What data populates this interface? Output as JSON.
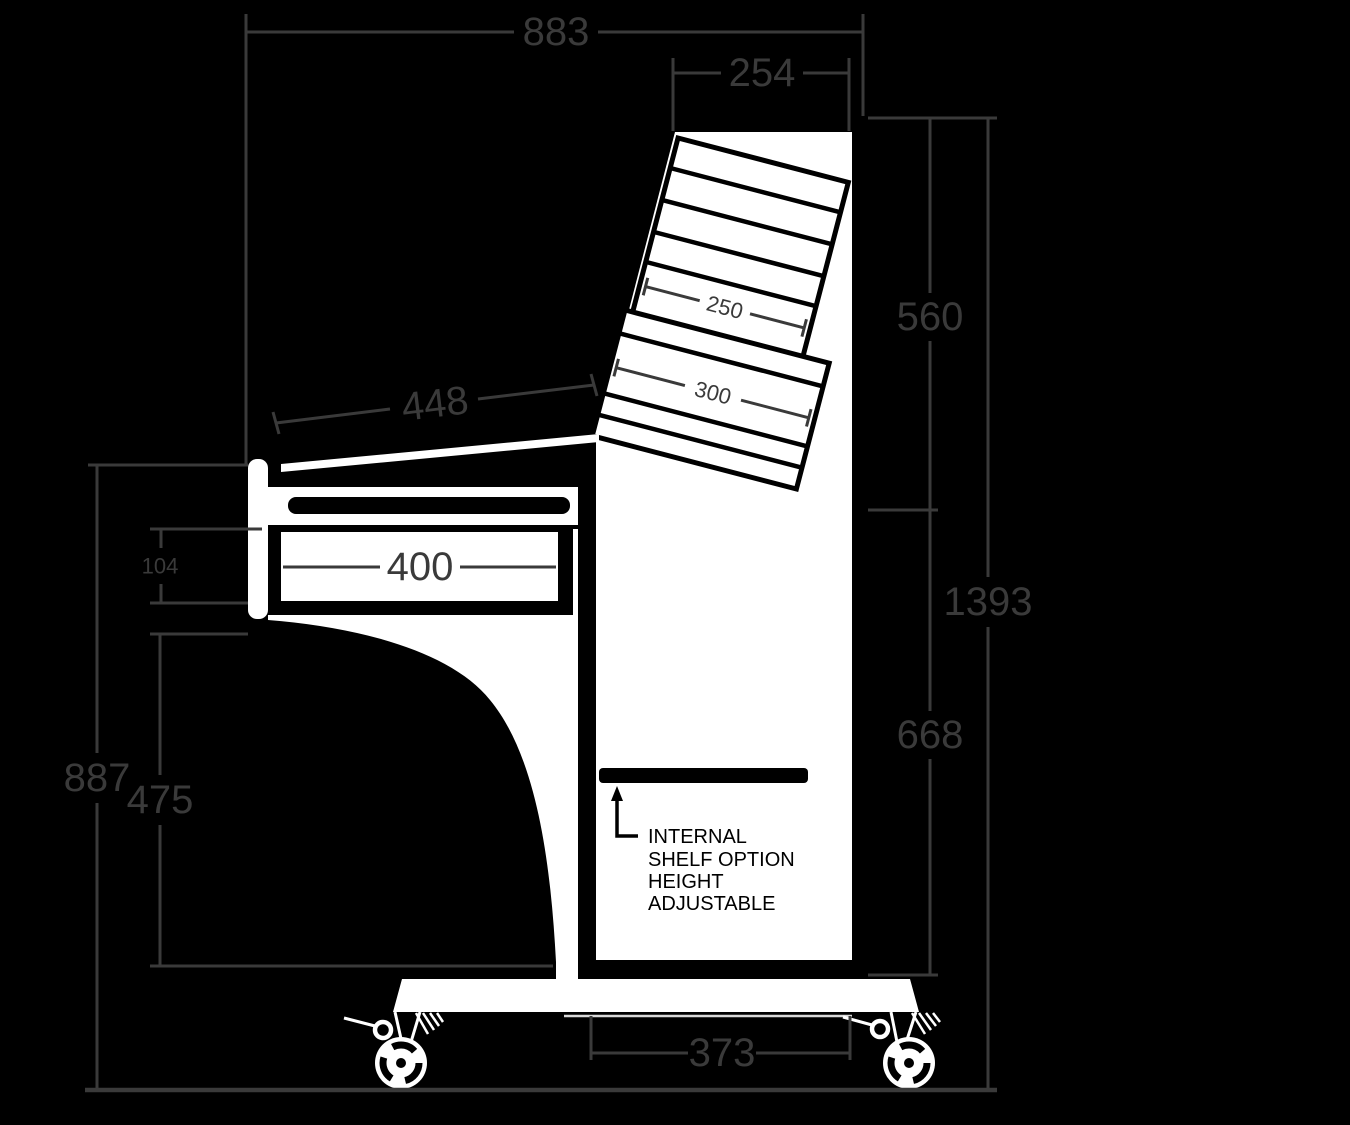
{
  "colors": {
    "background": "#000000",
    "drawing_white": "#ffffff",
    "drawing_black": "#000000",
    "dimension_gray": "#3a3a3a"
  },
  "dims": {
    "overall_width": "883",
    "top_section_width": "254",
    "rack_section_height": "560",
    "overall_height": "1393",
    "pedestal_height": "668",
    "desk_left_height": "887",
    "cabinet_height": "475",
    "drawer_front_height": "104",
    "drawer_width": "400",
    "worktop_depth": "448",
    "base_recess_width": "373",
    "upper_rack_depth": "250",
    "lower_rack_depth": "300"
  },
  "note": {
    "line1": "INTERNAL",
    "line2": "SHELF OPTION",
    "line3": "HEIGHT",
    "line4": "ADJUSTABLE"
  }
}
